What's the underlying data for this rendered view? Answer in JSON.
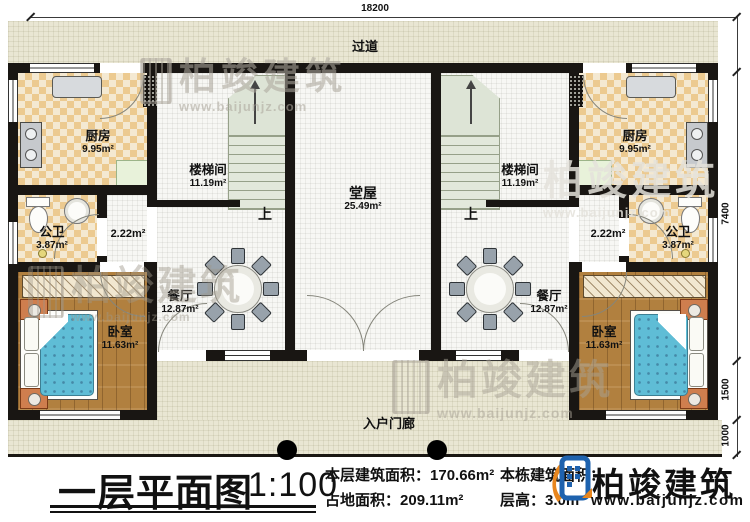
{
  "title_block": {
    "title": "一层平面图",
    "scale": "1:100",
    "floor_area_label": "本层建筑面积：",
    "floor_area_value": "170.66m²",
    "land_area_label": "占地面积：",
    "land_area_value": "209.11m²",
    "building_area_label": "本栋建筑面积：",
    "floor_height_label": "层高：",
    "floor_height_value": "3.0m"
  },
  "logo": {
    "brand": "柏竣建筑",
    "website": "www.baijunjz.com"
  },
  "watermark": {
    "brand": "柏竣建筑",
    "website": "www.baijunjz.com"
  },
  "dimensions": {
    "top_width": "18200",
    "right_main": "7400",
    "right_porch": "1500",
    "right_step": "1000"
  },
  "labels": {
    "corridor": "过道",
    "entry_porch": "入户门廊",
    "stairs_up": "上"
  },
  "rooms": {
    "kitchen": {
      "name": "厨房",
      "area": "9.95m²"
    },
    "stairwell": {
      "name": "楼梯间",
      "area": "11.19m²"
    },
    "hall": {
      "name": "堂屋",
      "area": "25.49m²"
    },
    "bathroom": {
      "name": "公卫",
      "area": "3.87m²"
    },
    "small_hall": {
      "area": "2.22m²"
    },
    "dining": {
      "name": "餐厅",
      "area": "12.87m²"
    },
    "bedroom": {
      "name": "卧室",
      "area": "11.63m²"
    }
  },
  "colors": {
    "accent_blue": "#1e62ae",
    "accent_orange": "#e8861e",
    "wall": "#191613",
    "floor_beige": "#e9e6d3"
  }
}
